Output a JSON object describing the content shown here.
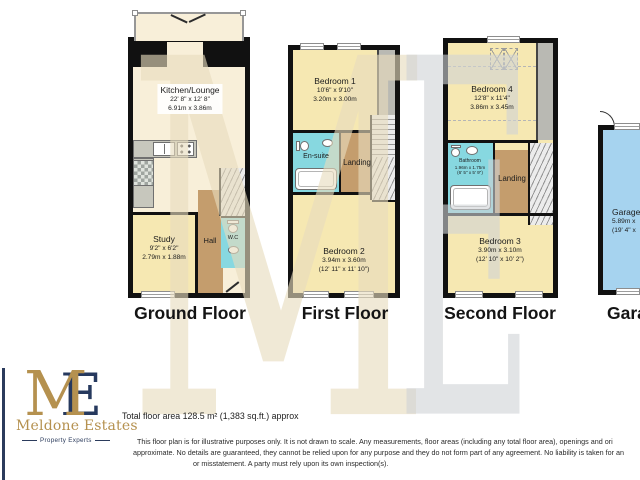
{
  "watermark": {
    "m": "M",
    "e": "E"
  },
  "logo": {
    "monogram_m": "M",
    "monogram_e": "E",
    "name": "Meldone Estates",
    "tagline": "Property Experts",
    "gold": "#b5914f",
    "navy": "#2b3b5c"
  },
  "floors": {
    "ground": {
      "title": "Ground Floor",
      "kitchen_lounge": {
        "name": "Kitchen/Lounge",
        "imperial": "22' 8\" x 12' 8\"",
        "metric": "6.91m x 3.86m"
      },
      "study": {
        "name": "Study",
        "imperial": "9'2\" x 6'2\"",
        "metric": "2.79m x 1.88m"
      },
      "hall": {
        "name": "Hall"
      },
      "wc": {
        "name": "W.C"
      }
    },
    "first": {
      "title": "First Floor",
      "bedroom1": {
        "name": "Bedroom 1",
        "imperial": "10'6\" x 9'10\"",
        "metric": "3.20m x 3.00m"
      },
      "ensuite": {
        "name": "En-suite"
      },
      "landing": {
        "name": "Landing"
      },
      "bedroom2": {
        "name": "Bedroom 2",
        "metric": "3.94m x 3.60m",
        "imperial": "(12' 11\" x 11' 10\")"
      }
    },
    "second": {
      "title": "Second Floor",
      "bedroom4": {
        "name": "Bedroom 4",
        "imperial": "12'8\" x 11'4\"",
        "metric": "3.86m x 3.45m"
      },
      "bathroom": {
        "name": "Bathroom",
        "metric": "1.96m x 1.75m",
        "imperial": "(6' 5\" x 5' 9\")"
      },
      "landing": {
        "name": "Landing"
      },
      "bedroom3": {
        "name": "Bedroom 3",
        "metric": "3.90m x 3.10m",
        "imperial": "(12' 10\" x 10' 2\")"
      }
    },
    "garage": {
      "title": "Garage",
      "room": {
        "name": "Garage",
        "metric": "5.89m x",
        "imperial": "(19' 4\" x"
      }
    }
  },
  "footer": {
    "total_area": "Total floor area 128.5 m² (1,383 sq.ft.) approx",
    "disclaimer_line1": "This floor plan is for illustrative purposes only. It is not drawn to scale. Any measurements, floor areas (including any total floor area), openings and ori",
    "disclaimer_line2": "approximate. No details are guaranteed, they cannot be relied upon for any purpose and they do not form part of any agreement. No liability is taken for an",
    "disclaimer_line3": "or misstatement. A party must rely upon its own inspection(s)."
  }
}
